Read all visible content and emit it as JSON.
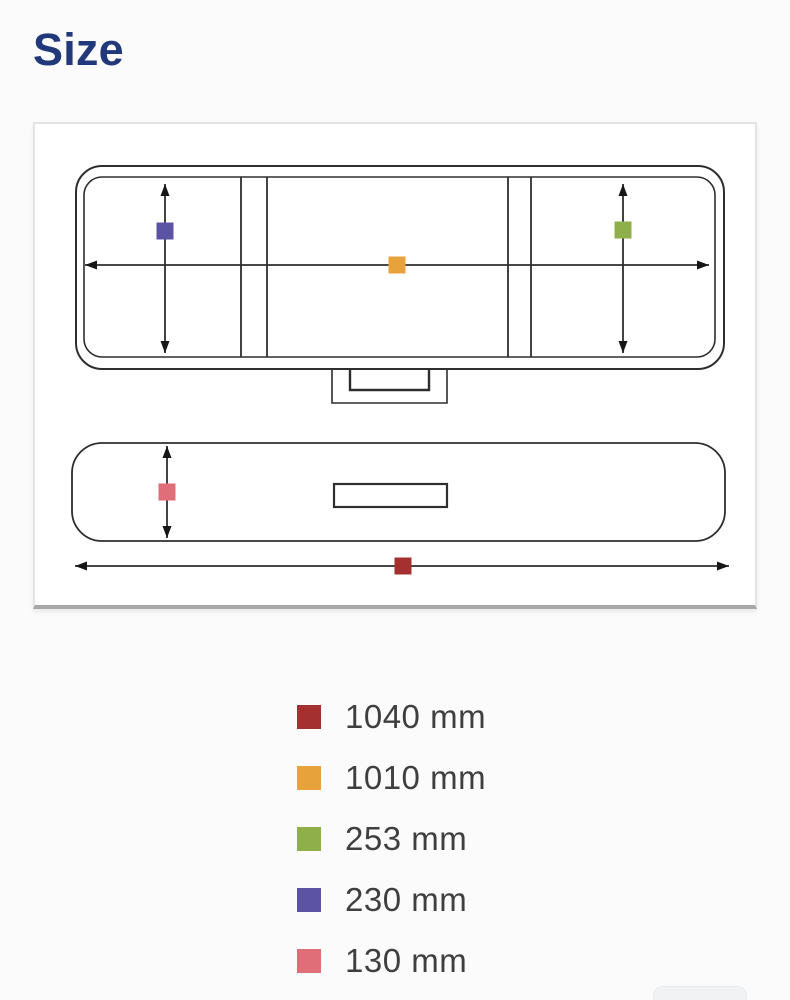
{
  "section": {
    "title": "Size"
  },
  "theme": {
    "title_color": "#21397a",
    "legend_text_color": "#3f3f3f",
    "diagram_line_color": "#2e2e2e",
    "card_background": "#ffffff",
    "page_background": "#fbfbfb"
  },
  "measurements": [
    {
      "label": "1040 mm",
      "value_mm": 1040,
      "color": "#a53030",
      "arrow": "overall-length-front-view"
    },
    {
      "label": "1010 mm",
      "value_mm": 1010,
      "color": "#e7a23b",
      "arrow": "inner-width-top-view"
    },
    {
      "label": "253 mm",
      "value_mm": 253,
      "color": "#8faf4b",
      "arrow": "right-depth-top-view"
    },
    {
      "label": "230 mm",
      "value_mm": 230,
      "color": "#5d53a5",
      "arrow": "left-depth-top-view"
    },
    {
      "label": "130 mm",
      "value_mm": 130,
      "color": "#e06e79",
      "arrow": "height-front-view"
    }
  ]
}
